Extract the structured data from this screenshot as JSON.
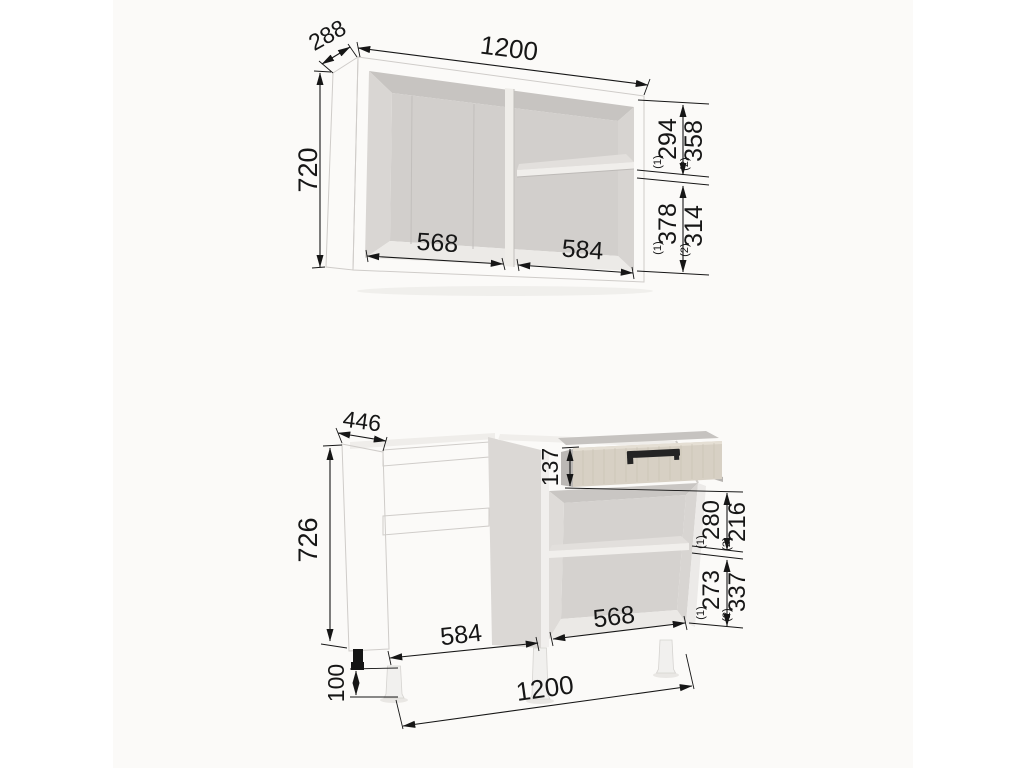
{
  "colors": {
    "page_background": "#ffffff",
    "drawing_background": "#fbfaf8",
    "carcass_light": "#eceae7",
    "carcass_interior": "#d4d1ce",
    "drawer_wood": "#d7d0c4",
    "handle_black": "#242424",
    "dimension_ink": "#161616"
  },
  "wall_cabinet": {
    "width": "1200",
    "depth": "288",
    "height": "720",
    "left_inner_width": "568",
    "right_inner_width": "584",
    "upper_gap_variant1": "294",
    "upper_gap_variant2": "358",
    "lower_gap_variant1": "378",
    "lower_gap_variant2": "314",
    "variant1_mark": "(1)",
    "variant2_mark": "(2)"
  },
  "base_cabinet": {
    "width": "1200",
    "depth": "446",
    "body_height": "726",
    "leg_height": "100",
    "drawer_height": "137",
    "upper_gap_variant1": "280",
    "upper_gap_variant2": "216",
    "lower_gap_variant1": "273",
    "lower_gap_variant2": "337",
    "left_inner_width": "584",
    "right_inner_width": "568",
    "variant1_mark": "(1)",
    "variant2_mark": "(2)"
  }
}
